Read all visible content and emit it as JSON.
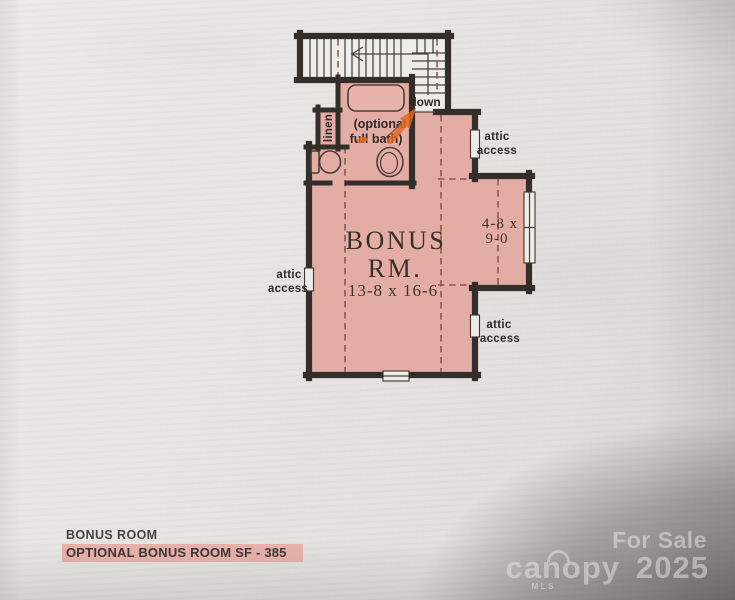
{
  "plan": {
    "stairs": {
      "down_label": "down"
    },
    "bath": {
      "optional_label_line1": "(optional",
      "optional_label_line2": "full bath)",
      "linen_label": "linen"
    },
    "room": {
      "name_line1": "BONUS",
      "name_line2": "RM.",
      "dimensions": "13-8 x 16-6"
    },
    "nook": {
      "dimensions_line1": "4-8 x",
      "dimensions_line2": "9-0"
    },
    "attic_access": {
      "line1": "attic",
      "line2": "access"
    }
  },
  "footer": {
    "room_title": "BONUS ROOM",
    "sf_highlight": "OPTIONAL BONUS ROOM SF - 385"
  },
  "watermark": {
    "for_sale": "For Sale",
    "brand": "canopy",
    "brand_sub": "MLS",
    "year": "2025"
  },
  "colors": {
    "room_fill": "#e3aca4",
    "tub_fill": "#e8b3ab",
    "wall": "#332e29",
    "dashed_line": "#8d5047",
    "marker_orange": "#e8671d",
    "highlight_bg": "#e9b1ab"
  }
}
